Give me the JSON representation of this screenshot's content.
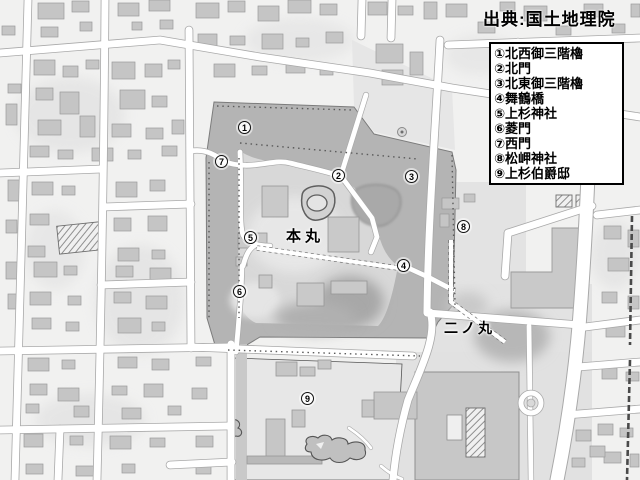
{
  "source": {
    "text": "出典:国土地理院"
  },
  "legend": {
    "items": [
      {
        "label": "①北西御三階櫓"
      },
      {
        "label": "②北門"
      },
      {
        "label": "③北東御三階櫓"
      },
      {
        "label": "④舞鶴橋"
      },
      {
        "label": "⑤上杉神社"
      },
      {
        "label": "⑥菱門"
      },
      {
        "label": "⑦西門"
      },
      {
        "label": "⑧松岬神社"
      },
      {
        "label": "⑨上杉伯爵邸"
      }
    ]
  },
  "map": {
    "area_labels": [
      {
        "text": "本丸",
        "x": 286,
        "y": 226
      },
      {
        "text": "二ノ丸",
        "x": 444,
        "y": 319
      }
    ],
    "markers": [
      {
        "glyph": "1",
        "x": 245,
        "y": 128
      },
      {
        "glyph": "2",
        "x": 339,
        "y": 176
      },
      {
        "glyph": "3",
        "x": 412,
        "y": 177
      },
      {
        "glyph": "4",
        "x": 404,
        "y": 266
      },
      {
        "glyph": "5",
        "x": 251,
        "y": 238
      },
      {
        "glyph": "6",
        "x": 240,
        "y": 292
      },
      {
        "glyph": "7",
        "x": 222,
        "y": 162
      },
      {
        "glyph": "8",
        "x": 464,
        "y": 227
      },
      {
        "glyph": "9",
        "x": 308,
        "y": 399
      }
    ]
  },
  "colors": {
    "background": "#f1f1f0",
    "moat_grounds": "#b4b4b4",
    "inner_bailey": "#d8d8d8",
    "building": "#c5c5c5",
    "road": "#ffffff",
    "text": "#000000",
    "legend_background": "#ffffff"
  }
}
